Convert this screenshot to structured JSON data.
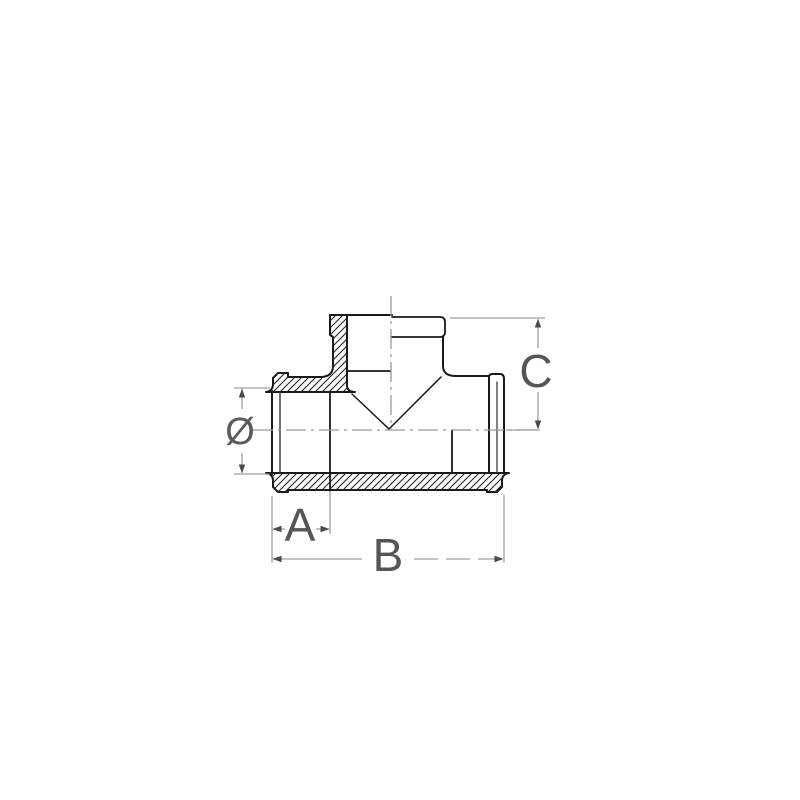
{
  "drawing": {
    "labels": {
      "diameter": "Ø",
      "a": "A",
      "b": "B",
      "c": "C"
    },
    "colors": {
      "background": "#ffffff",
      "outline": "#1a1a1a",
      "hatch": "#222222",
      "centerline": "#999999",
      "dimension_line": "#8a8a8a",
      "arrow": "#4a4a4a",
      "label_text": "#555555"
    }
  }
}
